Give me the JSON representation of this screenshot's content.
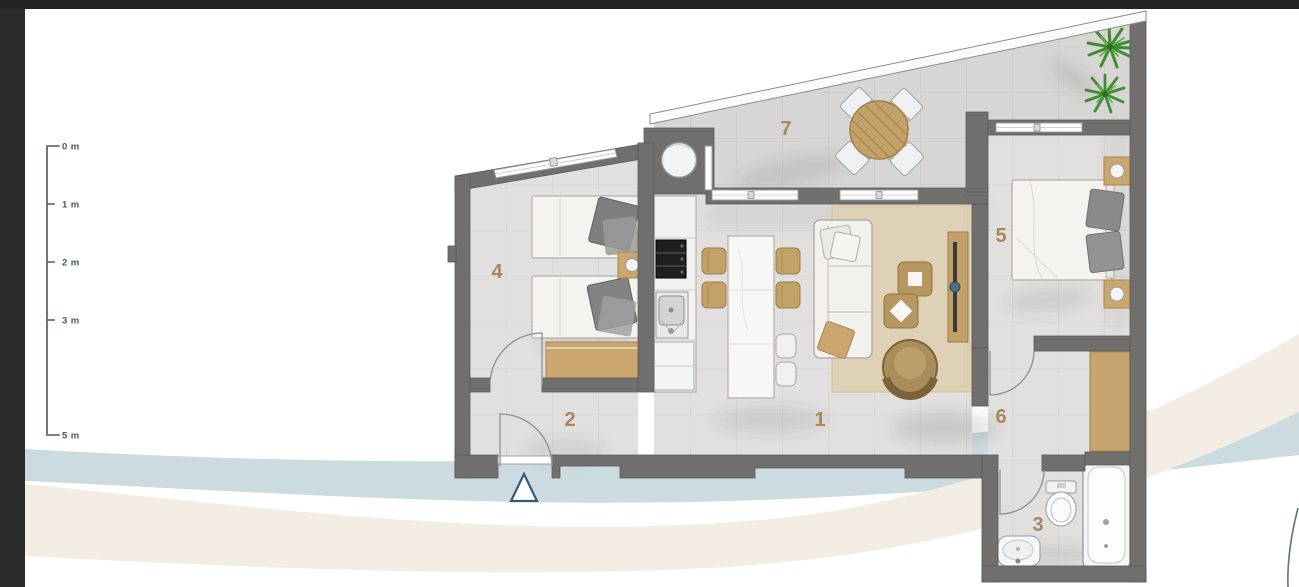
{
  "scale_bar": {
    "labels": [
      "0 m",
      "1 m",
      "2 m",
      "3 m",
      "5 m"
    ]
  },
  "floorplan": {
    "rooms": [
      {
        "label": "1"
      },
      {
        "label": "2"
      },
      {
        "label": "3"
      },
      {
        "label": "4"
      },
      {
        "label": "5"
      },
      {
        "label": "6"
      },
      {
        "label": "7"
      }
    ]
  },
  "colors": {
    "frame": "#262626",
    "side_strip": "#2b2b2b",
    "wall": "#706f6e",
    "floor": "#e1e0de",
    "terrace_floor": "#d7d6d4",
    "room_label": "#a8865e",
    "wood": "#c7a46c",
    "rug": "#ded1b6",
    "wave_blue": "#ccdbe0",
    "wave_cream": "#f3ede4",
    "scale": "#45586b",
    "plant": "#3f8d33",
    "entrance_marker": "#2d5e77",
    "corner_arc": "#567585"
  }
}
